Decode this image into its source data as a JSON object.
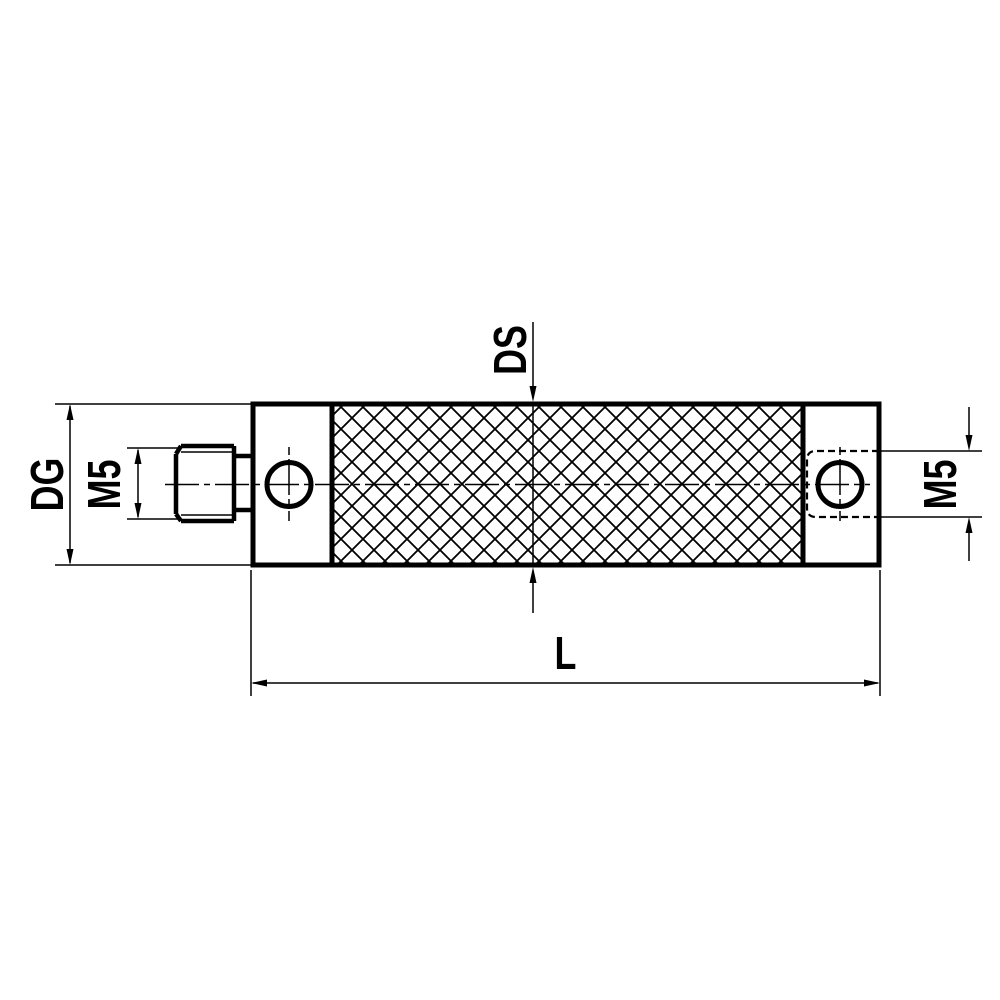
{
  "drawing": {
    "background_color": "#ffffff",
    "line_color": "#000000",
    "labels": {
      "dg": "DG",
      "m5_left": "M5",
      "ds": "DS",
      "m5_right": "M5",
      "l": "L"
    }
  }
}
